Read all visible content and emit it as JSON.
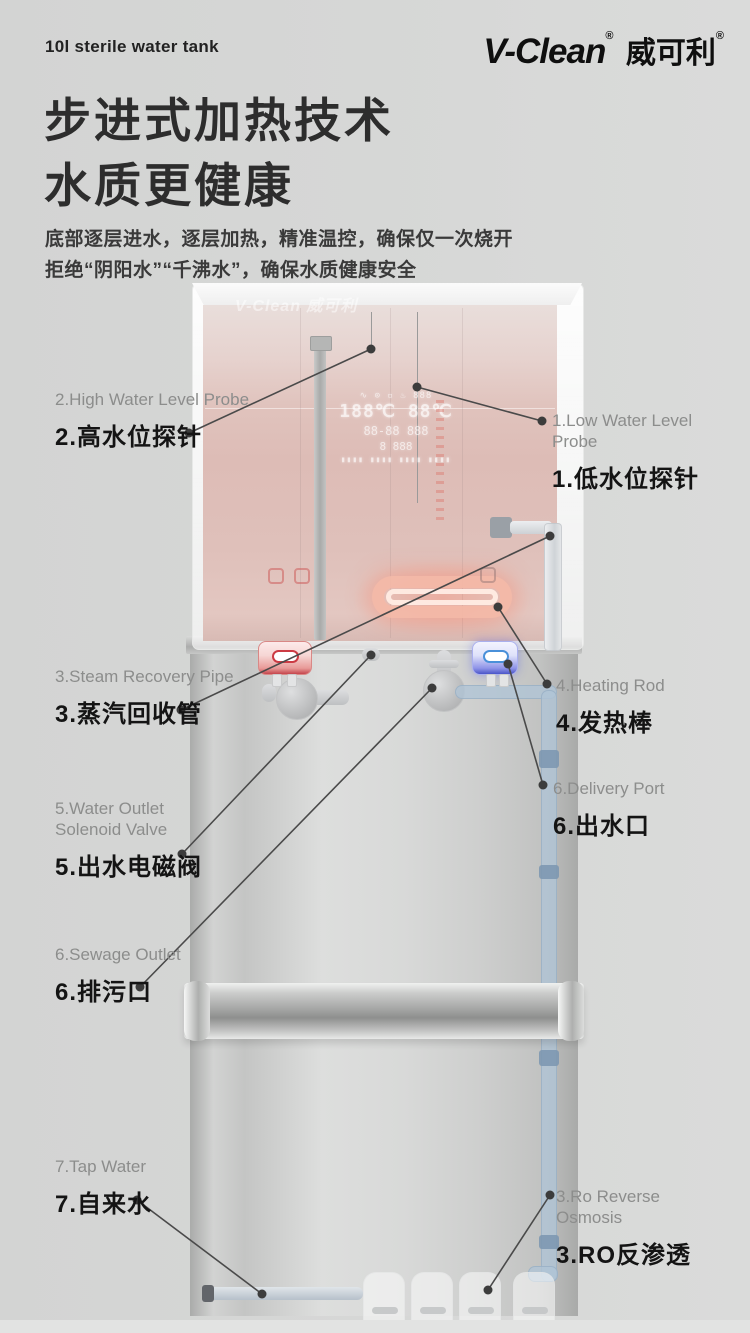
{
  "header": {
    "tagline": "10l sterile water tank",
    "brand_en": "V-Clean",
    "brand_cn": "威可利",
    "reg_mark": "®",
    "title_line1": "步进式加热技术",
    "title_line2": "水质更健康",
    "desc_line1": "底部逐层进水，逐层加热，精准温控，确保仅一次烧开",
    "desc_line2": "拒绝“阴阳水”“千沸水”，确保水质健康安全"
  },
  "diagram": {
    "watermark": "V-Clean 威可利",
    "display": {
      "rows": [
        "∿ ⊙ ▫ ♨ 888",
        "188℃ 88℃",
        "88-88  888",
        "8    888",
        "▮▮▮▮ ▮▮▮▮ ▮▮▮▮ ▮▮▮▮"
      ]
    },
    "labels": [
      {
        "id": "high-water-level-probe",
        "en": "2.High Water Level Probe",
        "cn": "2.高水位探针"
      },
      {
        "id": "low-water-level-probe",
        "en": "1.Low Water Level\nProbe",
        "cn": "1.低水位探针"
      },
      {
        "id": "steam-recovery-pipe",
        "en": "3.Steam Recovery Pipe",
        "cn": "3.蒸汽回收管"
      },
      {
        "id": "heating-rod",
        "en": "4.Heating Rod",
        "cn": "4.发热棒"
      },
      {
        "id": "water-outlet-solenoid-valve",
        "en": "5.Water Outlet\nSolenoid Valve",
        "cn": "5.出水电磁阀"
      },
      {
        "id": "delivery-port",
        "en": "6.Delivery Port",
        "cn": "6.出水口"
      },
      {
        "id": "sewage-outlet",
        "en": "6.Sewage Outlet",
        "cn": "6.排污口"
      },
      {
        "id": "tap-water",
        "en": "7.Tap Water",
        "cn": "7.自来水"
      },
      {
        "id": "ro-reverse-osmosis",
        "en": "3.Ro Reverse\nOsmosis",
        "cn": "3.RO反渗透"
      }
    ],
    "leader_lines": [
      {
        "from": [
          189,
          433
        ],
        "to": [
          371,
          349
        ]
      },
      {
        "from": [
          542,
          421
        ],
        "to": [
          417,
          387
        ]
      },
      {
        "from": [
          181,
          710
        ],
        "to": [
          550,
          536
        ]
      },
      {
        "from": [
          547,
          684
        ],
        "to": [
          498,
          607
        ]
      },
      {
        "from": [
          182,
          854
        ],
        "to": [
          371,
          655
        ]
      },
      {
        "from": [
          543,
          785
        ],
        "to": [
          508,
          664
        ]
      },
      {
        "from": [
          140,
          987
        ],
        "to": [
          432,
          688
        ]
      },
      {
        "from": [
          137,
          1200
        ],
        "to": [
          262,
          1294
        ]
      },
      {
        "from": [
          550,
          1195
        ],
        "to": [
          488,
          1290
        ]
      }
    ]
  },
  "colors": {
    "background": "#d5d6d5",
    "accent_red": "#c4454d",
    "accent_blue": "#4a90d9",
    "label_en": "#8c8d8c",
    "label_cn": "#141414",
    "leader_line": "#4a4a4a"
  }
}
